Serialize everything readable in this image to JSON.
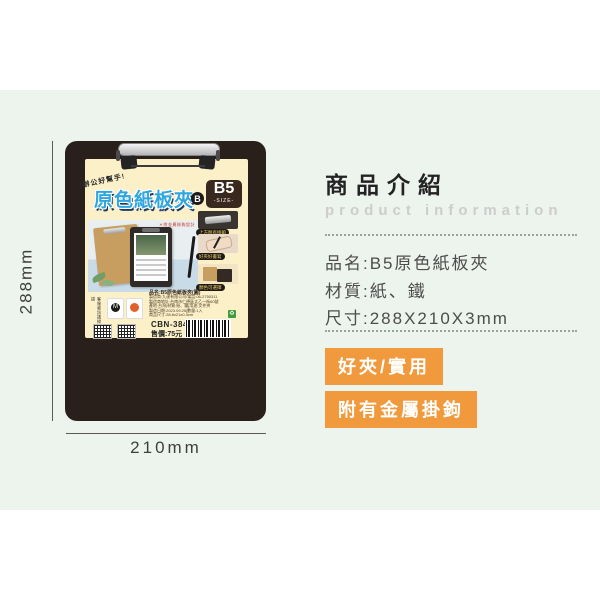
{
  "dimension_annotations": {
    "height": "288mm",
    "width": "210mm"
  },
  "packaging": {
    "hook_note": "!辦公好幫手!",
    "product_title": "原色紙板夾",
    "grade_badge": "B",
    "size_value": "B5",
    "size_caption": "-SIZE-",
    "photo_caption": "＊附金屬掛鉤設計",
    "features": [
      {
        "caption": "上方附有掛鉤"
      },
      {
        "caption": "好夾好書寫"
      },
      {
        "caption": "顏色可選擇"
      }
    ],
    "spec_block": {
      "name_line": "品名:B5原色紙板夾(圓)",
      "detail_lines": [
        "製造商:九達有限公司/電話:06-2750311",
        "製造商地址:台南市仁德區太乙一街60號",
        "產地:台灣|材質:紙、鐵|用途:文件夾",
        "製造日期:2023.09.25|數量:1入",
        "商品尺寸:28.8x21x0.3cm"
      ],
      "model": "CBN-384B",
      "price": "售價:75元",
      "service_note": "客服資訊請掃描",
      "brand_initial": "M",
      "recycle_mark": "♻"
    }
  },
  "info_panel": {
    "title": "商品介紹",
    "subtitle": "product information",
    "specs": [
      "品名:B5原色紙板夾",
      "材質:紙、鐵",
      "尺寸:288X210X3mm"
    ],
    "badges": [
      "好夾/實用",
      "附有金屬掛鉤"
    ]
  },
  "colors": {
    "band_green": "#edf3ed",
    "clipboard_dark": "#2a201b",
    "label_cream": "#fbf0c8",
    "title_blue": "#2fa6de",
    "badge_orange": "#f09a3d"
  }
}
